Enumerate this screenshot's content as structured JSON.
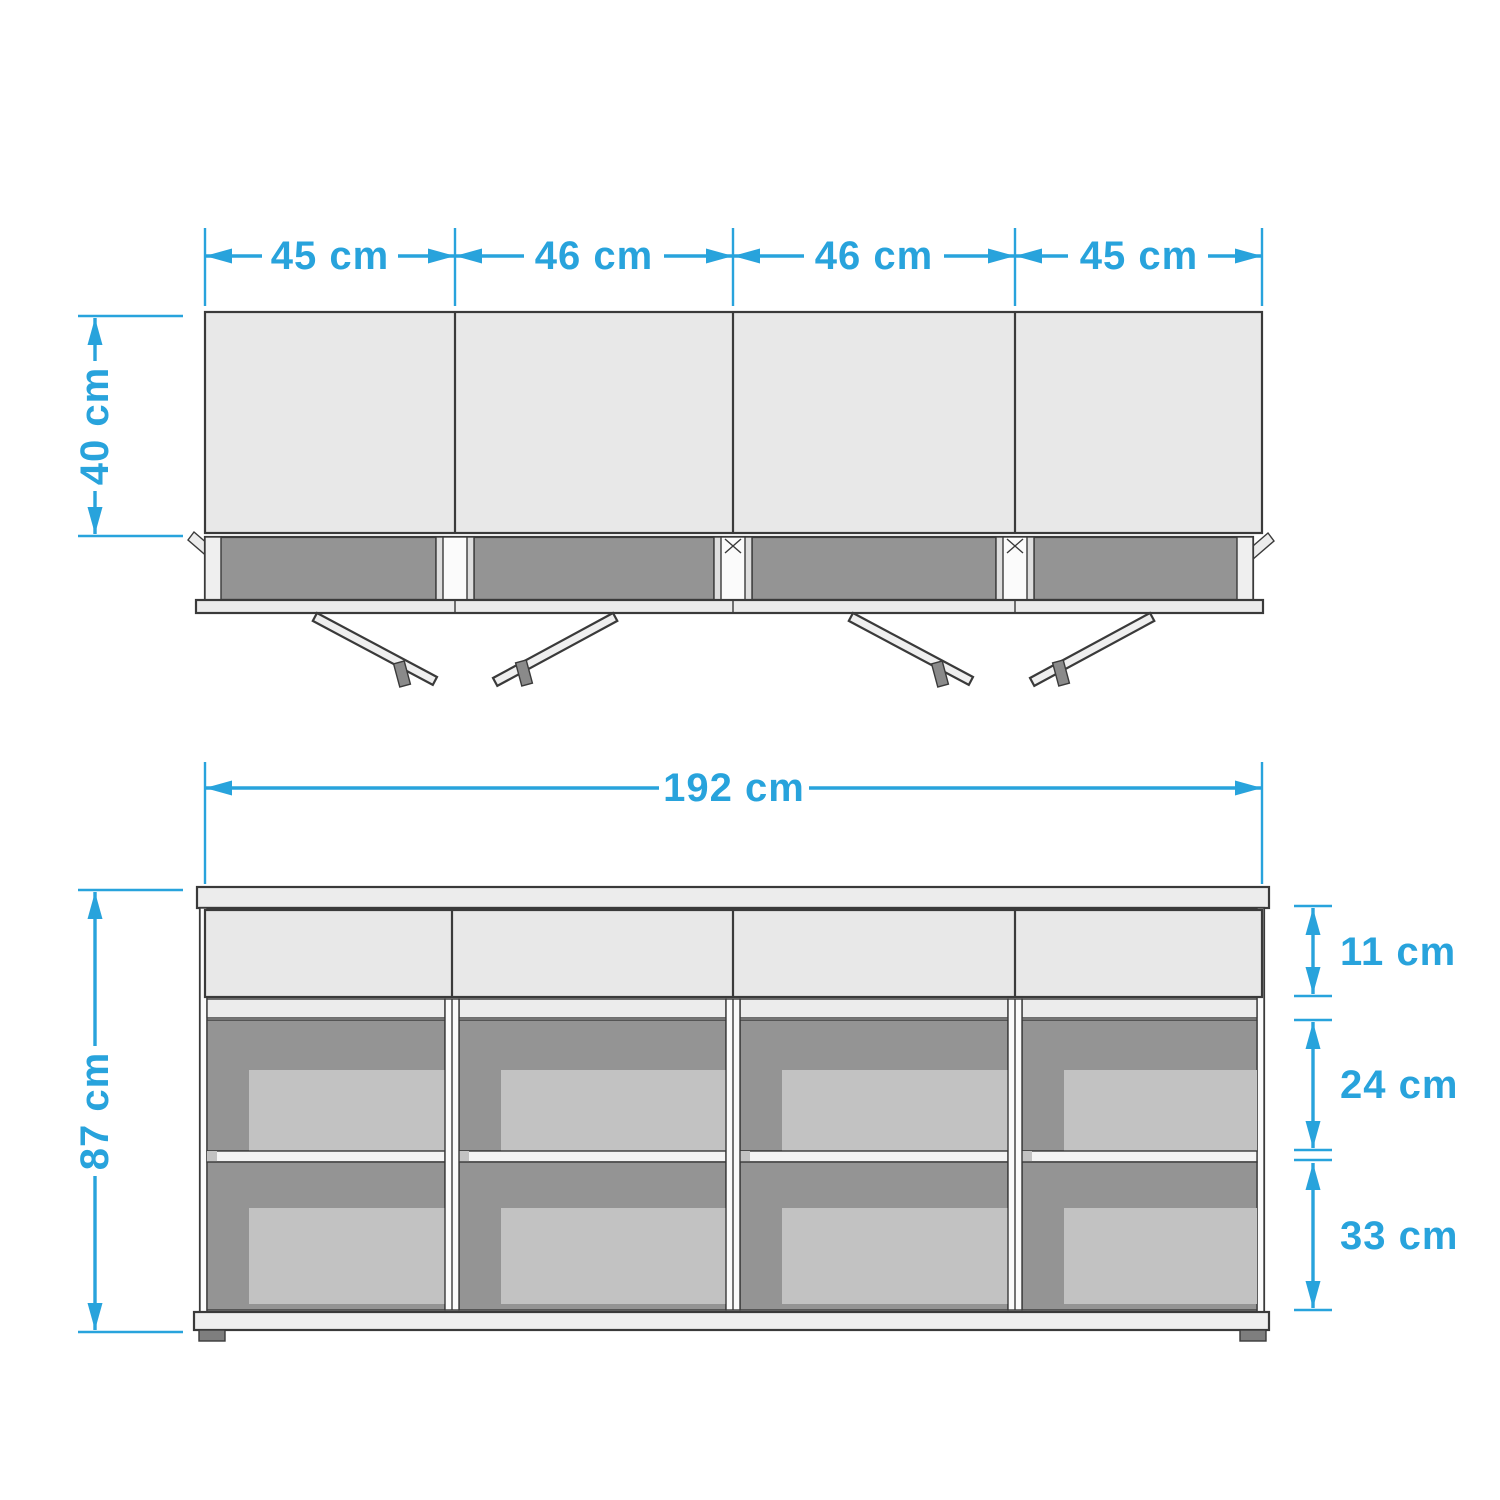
{
  "colors": {
    "accent": "#28A3DC",
    "panel": "#E8E8E8",
    "interior": "#949494",
    "inset": "#C2C2C2"
  },
  "diagram": {
    "type": "furniture dimension drawing",
    "views": [
      "top view with doors open",
      "front view with shelves"
    ]
  },
  "top_view": {
    "door_widths": [
      {
        "label": "45 cm"
      },
      {
        "label": "46 cm"
      },
      {
        "label": "46 cm"
      },
      {
        "label": "45 cm"
      }
    ],
    "depth": {
      "label": "40 cm"
    }
  },
  "front_view": {
    "total_width": {
      "label": "192 cm"
    },
    "total_height": {
      "label": "87 cm"
    },
    "sections": [
      {
        "name": "drawer height",
        "label": "11 cm"
      },
      {
        "name": "upper compartment height",
        "label": "24 cm"
      },
      {
        "name": "lower compartment height",
        "label": "33 cm"
      }
    ]
  }
}
